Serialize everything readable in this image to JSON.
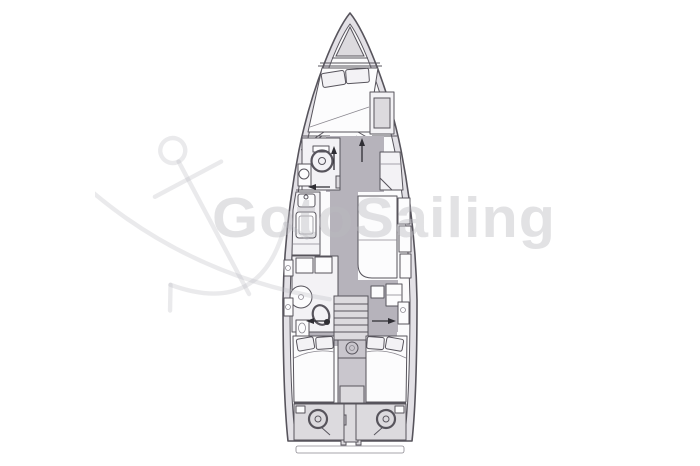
{
  "canvas": {
    "width": 700,
    "height": 466,
    "background": "#ffffff"
  },
  "watermark": {
    "text": "GotoSailing",
    "color": "rgba(186,186,191,0.42)",
    "anchor_icon": "anchor-sketch-icon"
  },
  "theme": {
    "bg": "#ffffff",
    "line": "#57545c",
    "line2": "#8b8890",
    "deck": "#e3e1e6",
    "cabin": "#fbfbfc",
    "furniture": "#f3f2f5",
    "berth": "#fcfcfd",
    "floor": "#b6b3bb",
    "panel": "#dcdade",
    "console": "#c9c6cd",
    "arrow": "#2f2e34",
    "wm": "rgba(186,186,191,0.42)",
    "wmline": "rgba(186,186,191,0.30)"
  },
  "diagram": {
    "type": "sailboat-interior-floorplan",
    "view": "top-down",
    "regions": [
      "bow-anchor-locker",
      "v-berth-forward-cabin",
      "forward-wardrobe",
      "forward-head-toilet",
      "galley-sink",
      "galley-stove",
      "salon-settee",
      "nav-seat",
      "aft-head-shower",
      "aft-head-toilet",
      "companionway-stairs",
      "engine-compartment",
      "port-aft-berth",
      "starboard-aft-berth",
      "port-helm-wheel",
      "starboard-helm-wheel",
      "swim-platform"
    ]
  }
}
